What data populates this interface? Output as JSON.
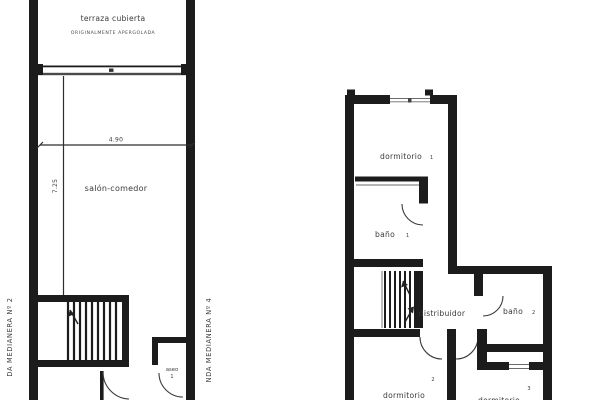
{
  "page": {
    "background": "#ffffff",
    "wall_color": "#1c1c1c",
    "text_color": "#3a3a3a"
  },
  "ground_floor_plan": {
    "rooms": {
      "terraza": {
        "label": "terraza cubierta",
        "note": "ORIGINALMENTE APERGOLADA"
      },
      "salon_comedor": {
        "label": "salón-comedor"
      },
      "aseo": {
        "label": "aseo",
        "number": "1"
      }
    },
    "dimensions": {
      "width_m": "4.90",
      "depth_m": "7.25"
    },
    "annotations": {
      "left_party_wall": "DA MEDIANERA Nº 2",
      "right_party_wall": "NDA MEDIANERA Nº 4"
    }
  },
  "upper_floor_plan": {
    "rooms": {
      "dormitorio_1": {
        "label": "dormitorio",
        "number": "1"
      },
      "bano_1": {
        "label": "baño",
        "number": "1"
      },
      "distribuidor": {
        "label": "distribuidor"
      },
      "bano_2": {
        "label": "baño",
        "number": "2"
      },
      "dormitorio_2": {
        "label": "dormitorio",
        "number": "2"
      },
      "dormitorio_3": {
        "label": "dormitorio",
        "number": "3"
      }
    }
  }
}
